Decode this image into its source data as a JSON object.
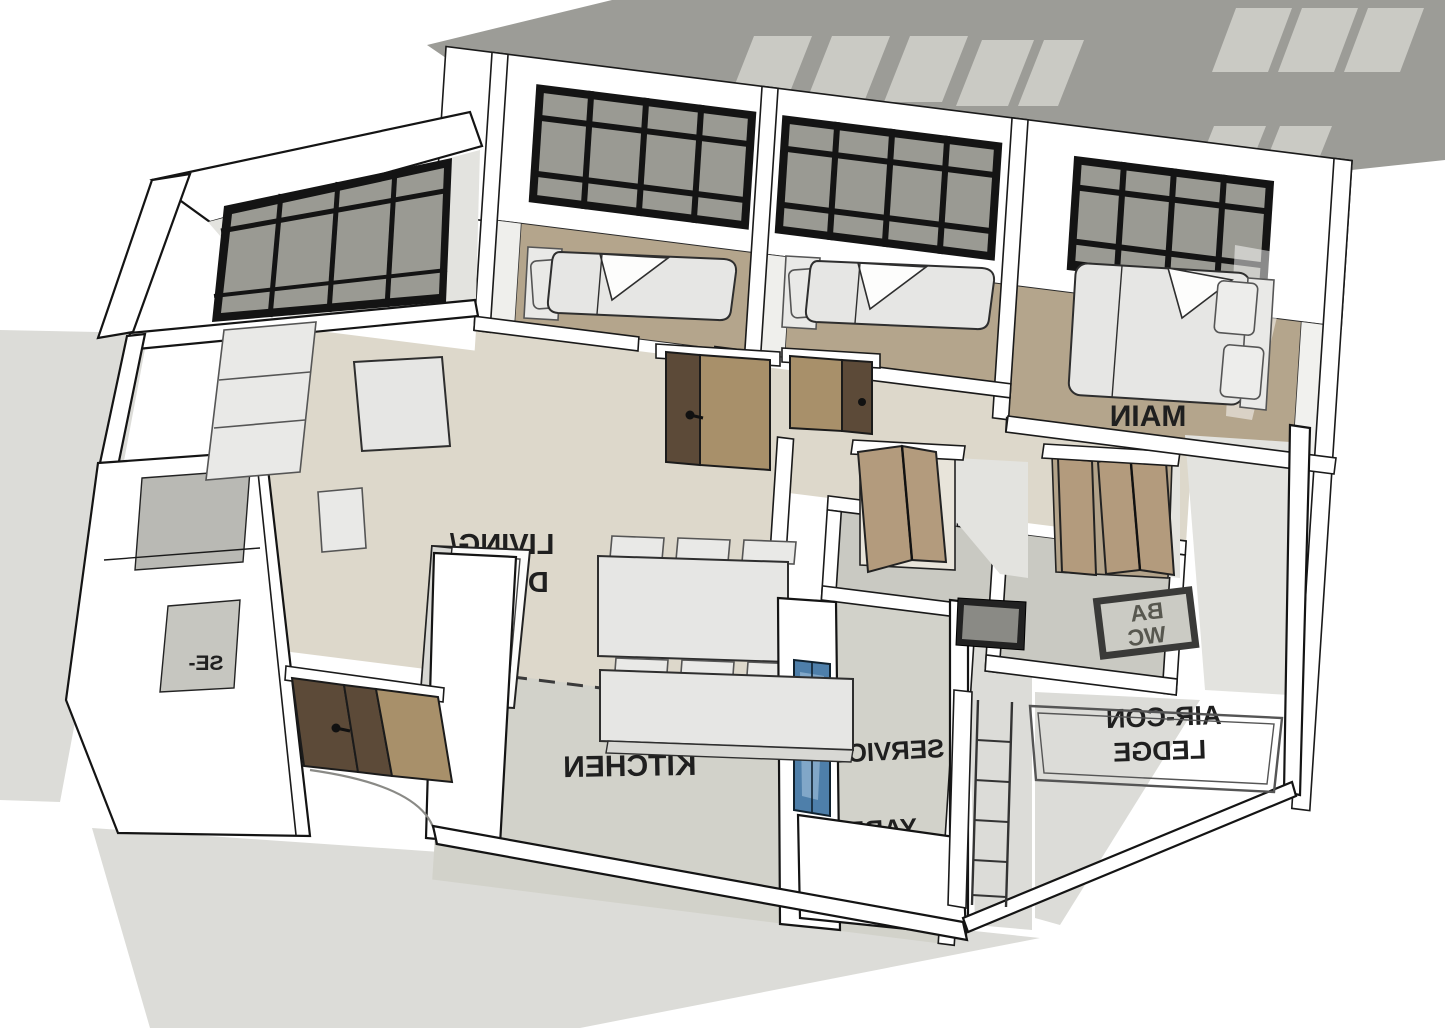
{
  "scene": {
    "description": "3D SketchUp-style isometric model of an apartment floor plan viewed from above",
    "note": "Floor labels appear mirrored due to the viewing angle of the 3D model"
  },
  "rooms": {
    "living_dining": {
      "line1": "LIVING/",
      "line2": "DINING"
    },
    "kitchen": {
      "line1": "KITCHEN"
    },
    "main_bedroom": {
      "line1": "MAIN"
    },
    "bathroom_panel": {
      "line1": "BA",
      "line2": "WC"
    },
    "aircon_ledge": {
      "line1": "AIR-CON",
      "line2": "LEDGE"
    },
    "service_yard": {
      "line1": "SERVICE",
      "line2": "YARD"
    },
    "shelter": {
      "line1": "SE-"
    }
  },
  "colors": {
    "background": "#ffffff",
    "shadow_band": "#9c9c97",
    "hatch": "#cacac4",
    "ground_shadow": "#dcdcd8",
    "wall_fill": "#ffffff",
    "wall_outline": "#1a1a1a",
    "floor_living": "#ddd8cb",
    "floor_bedroom": "#b4a58c",
    "floor_wet": "#c9c9c2",
    "window_frame": "#141414",
    "window_glass": "#9a9a93",
    "door_wood_light": "#a8906a",
    "door_wood_dark": "#5c4a38",
    "bifold_wood": "#b39b7d",
    "glass_door_blue": "#4e7faa",
    "label_text": "#1f1f1f"
  }
}
